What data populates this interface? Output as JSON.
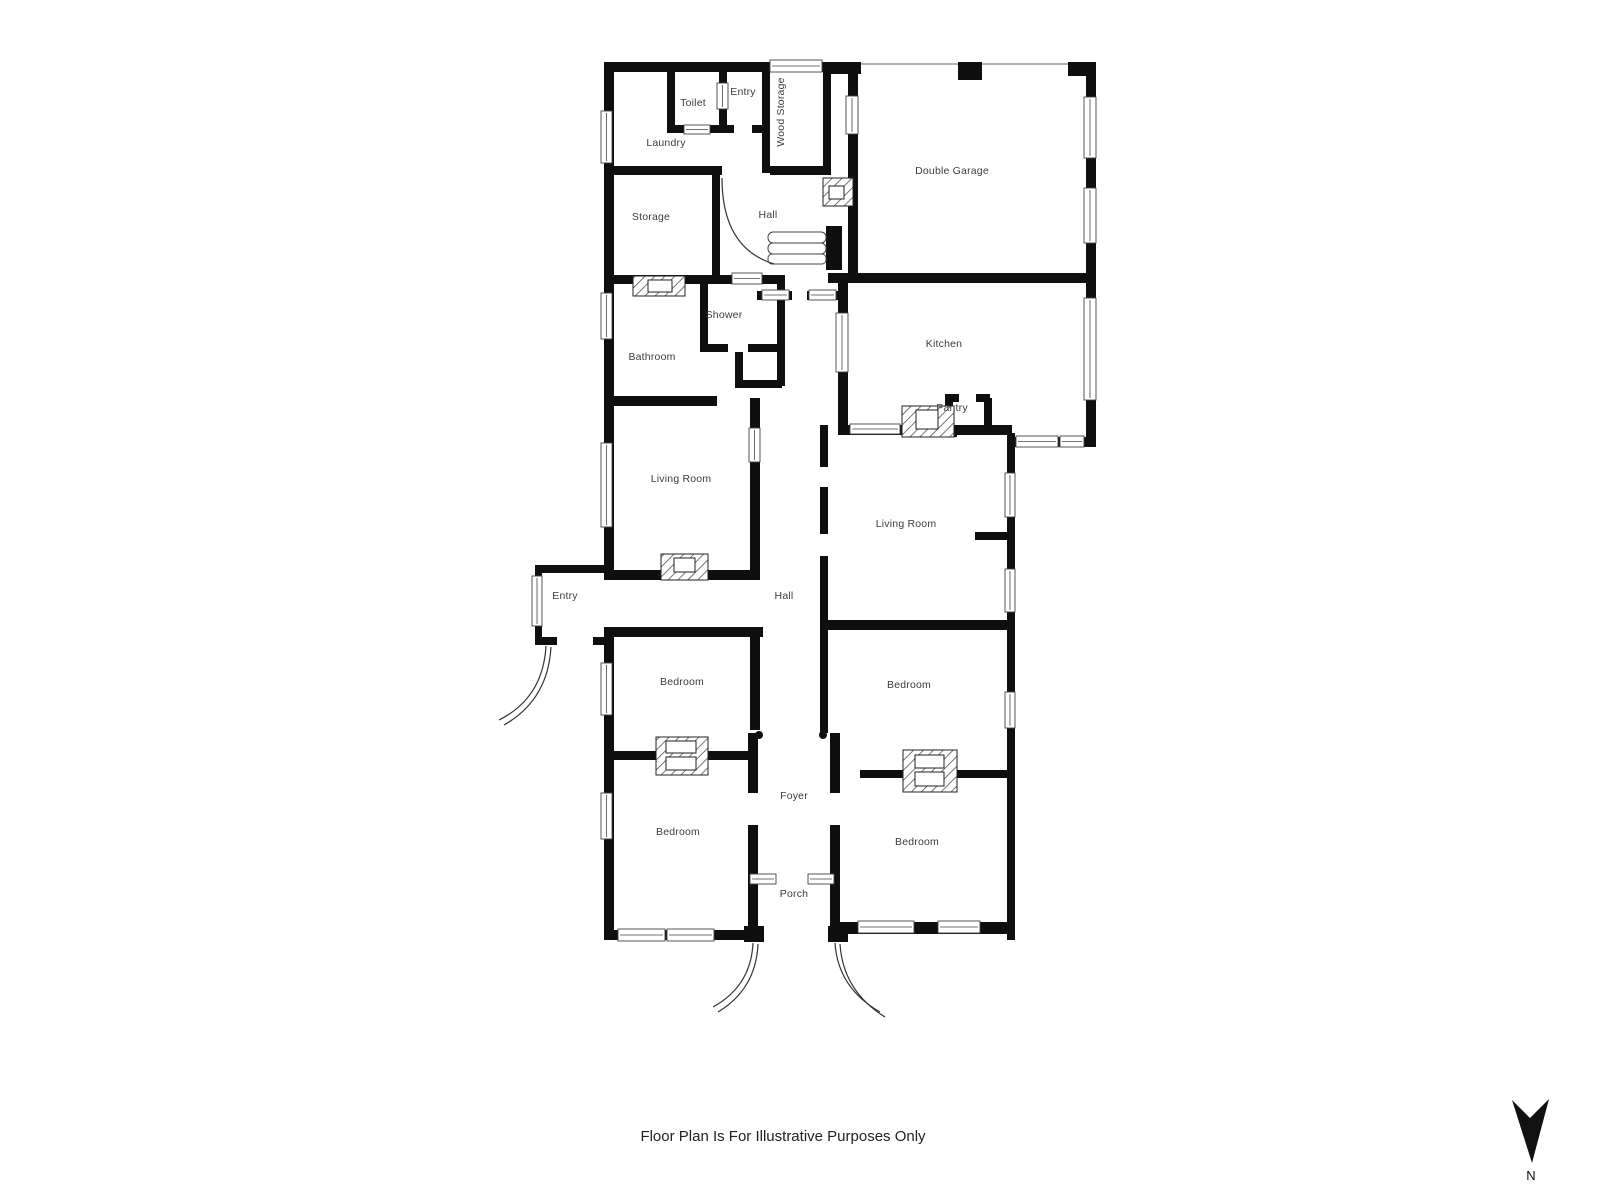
{
  "plan": {
    "rooms": [
      {
        "id": "toilet",
        "label": "Toilet"
      },
      {
        "id": "entry-top",
        "label": "Entry"
      },
      {
        "id": "laundry",
        "label": "Laundry"
      },
      {
        "id": "wood-storage",
        "label": "Wood Storage"
      },
      {
        "id": "double-garage",
        "label": "Double Garage"
      },
      {
        "id": "storage",
        "label": "Storage"
      },
      {
        "id": "hall-upper",
        "label": "Hall"
      },
      {
        "id": "shower",
        "label": "Shower"
      },
      {
        "id": "bathroom",
        "label": "Bathroom"
      },
      {
        "id": "kitchen",
        "label": "Kitchen"
      },
      {
        "id": "pantry",
        "label": "Pantry"
      },
      {
        "id": "living-room-left",
        "label": "Living Room"
      },
      {
        "id": "living-room-right",
        "label": "Living Room"
      },
      {
        "id": "entry-left",
        "label": "Entry"
      },
      {
        "id": "hall-corridor",
        "label": "Hall"
      },
      {
        "id": "bedroom-left-top",
        "label": "Bedroom"
      },
      {
        "id": "bedroom-right-top",
        "label": "Bedroom"
      },
      {
        "id": "bedroom-left-bottom",
        "label": "Bedroom"
      },
      {
        "id": "bedroom-right-bottom",
        "label": "Bedroom"
      },
      {
        "id": "foyer",
        "label": "Foyer"
      },
      {
        "id": "porch",
        "label": "Porch"
      }
    ],
    "footer": "Floor Plan Is For Illustrative Purposes Only",
    "compass": {
      "label": "N"
    },
    "colors": {
      "wall": "#0f0f0f",
      "label": "#3d3d3d",
      "accent_line": "#444444"
    }
  }
}
